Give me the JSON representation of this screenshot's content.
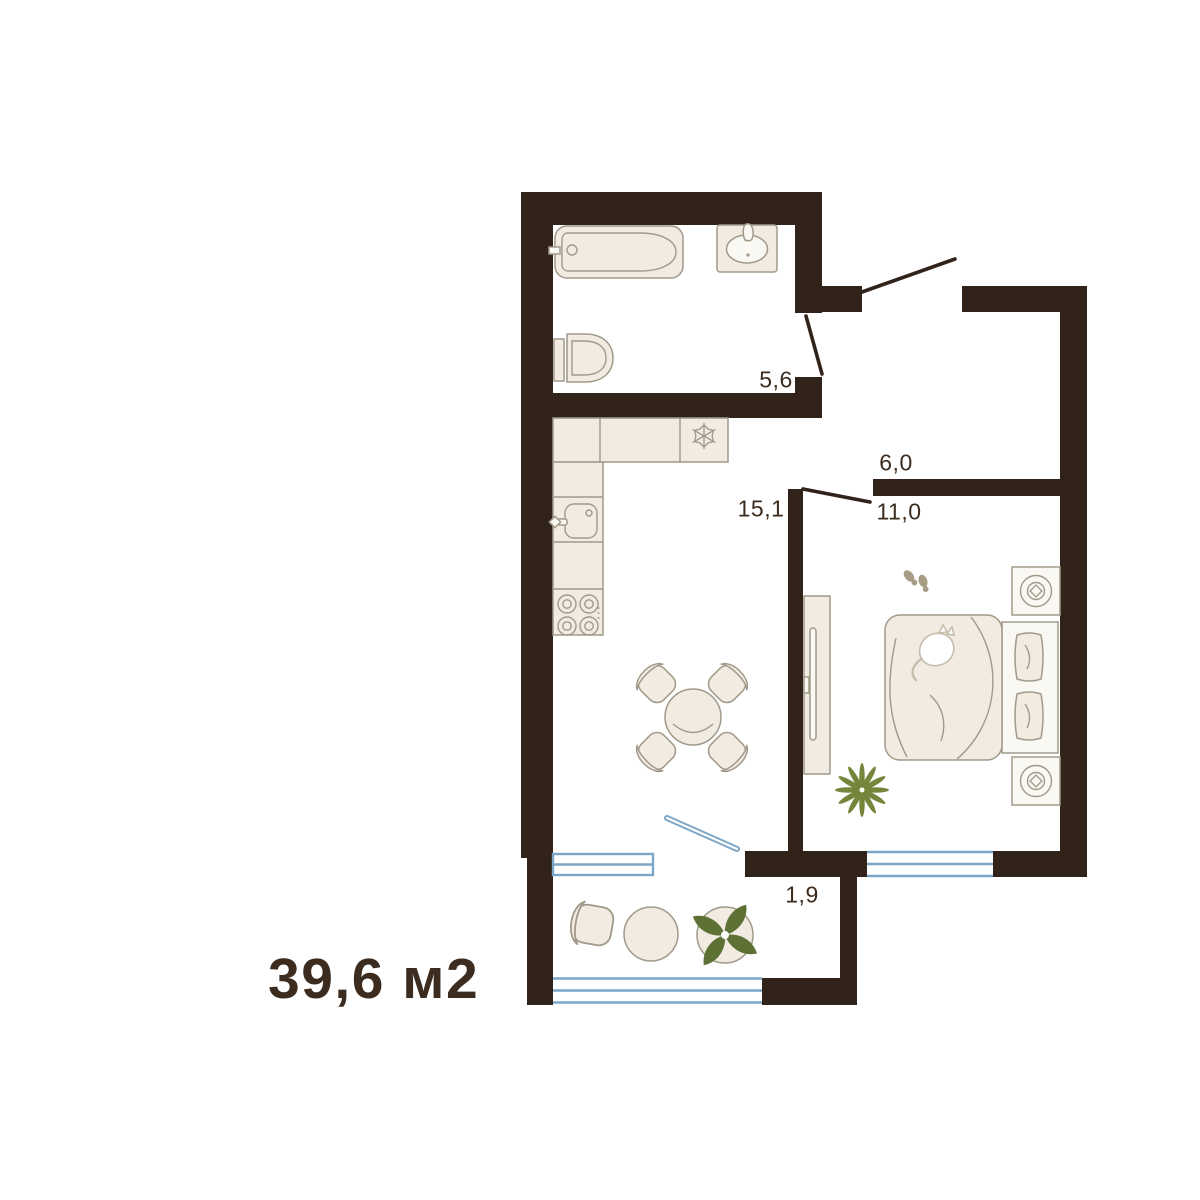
{
  "floorplan": {
    "total_area": "39,6 м2",
    "rooms": {
      "bathroom": {
        "area": "5,6"
      },
      "hallway": {
        "area": "6,0"
      },
      "kitchen_living": {
        "area": "15,1"
      },
      "bedroom": {
        "area": "11,0"
      },
      "balcony": {
        "area": "1,9"
      }
    }
  },
  "colors": {
    "wall": "#31231a",
    "furn": "#f1ebe1",
    "furnL": "#faf8f2",
    "outline": "#a19a8a",
    "window": "#7ba6c8",
    "text": "#3b2c1f",
    "green1": "#76853c",
    "green2": "#5d7134",
    "slipper": "#a89d85",
    "catline": "#c6beac"
  },
  "icons": {
    "fridge": "snowflake-glyph",
    "stove": "four-burner-glyph",
    "kitchen_sink": "basin-with-faucet-glyph",
    "bathtub": "tub-top-view-glyph",
    "bathroom_sink": "oval-basin-glyph",
    "toilet": "toilet-top-view-glyph",
    "bed": "double-bed-with-pillows-glyph",
    "cat": "sleeping-cat-glyph",
    "nightstand": "concentric-circle-lamp-glyph",
    "wardrobe": "sliding-wardrobe-glyph",
    "plant_small": "starburst-leaf-glyph",
    "plant_large": "broad-leaf-glyph",
    "slippers": "footprint-pair-glyph",
    "doors": "door-swing-glyph",
    "windows": "triple-line-window-glyph"
  }
}
